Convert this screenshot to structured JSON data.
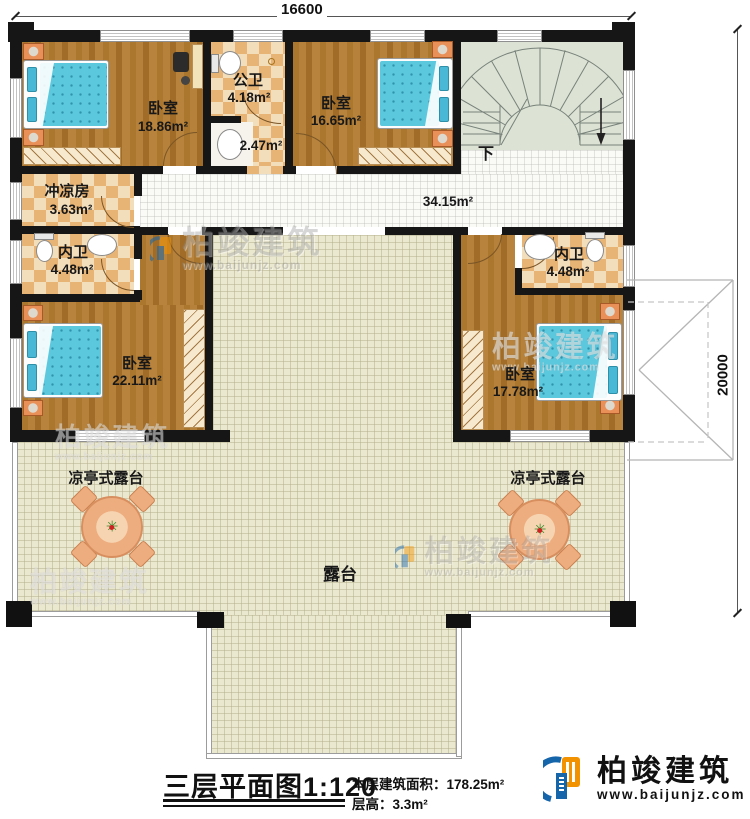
{
  "dimensions": {
    "top": "16600",
    "right": "20000"
  },
  "rooms": {
    "bedroom_tl": {
      "name": "卧室",
      "area": "18.86m²"
    },
    "public_bath": {
      "name": "公卫",
      "area": "4.18m²"
    },
    "washroom": {
      "area": "2.47m²"
    },
    "bedroom_tr": {
      "name": "卧室",
      "area": "16.65m²"
    },
    "stairs": {
      "down_label": "下"
    },
    "hall": {
      "area": "34.15m²"
    },
    "shower_room": {
      "name": "冲凉房",
      "area": "3.63m²"
    },
    "bath_left": {
      "name": "内卫",
      "area": "4.48m²"
    },
    "bedroom_bl": {
      "name": "卧室",
      "area": "22.11m²"
    },
    "bath_right": {
      "name": "内卫",
      "area": "4.48m²"
    },
    "bedroom_br": {
      "name": "卧室",
      "area": "17.78m²"
    },
    "terrace_left": {
      "name": "凉亭式露台"
    },
    "terrace_right": {
      "name": "凉亭式露台"
    },
    "terrace_main": {
      "name": "露台"
    }
  },
  "footer": {
    "title": "三层平面图",
    "scale": "1:120",
    "area_label": "本层建筑面积：",
    "area_value": "178.25m²",
    "floor_height_label": "层高：",
    "floor_height_value": "3.3m²"
  },
  "brand": {
    "name": "柏竣建筑",
    "url": "www.baijunjz.com"
  },
  "colors": {
    "wall": "#161616",
    "wood": "#b07a33",
    "tile_light": "#f3debb",
    "tile_dark": "#e8b475",
    "terrace": "#ebe8d0",
    "stairs": "#dce2d4",
    "bed": "#5cc8de",
    "accent_orange": "#f29200",
    "accent_blue": "#1565ab"
  }
}
